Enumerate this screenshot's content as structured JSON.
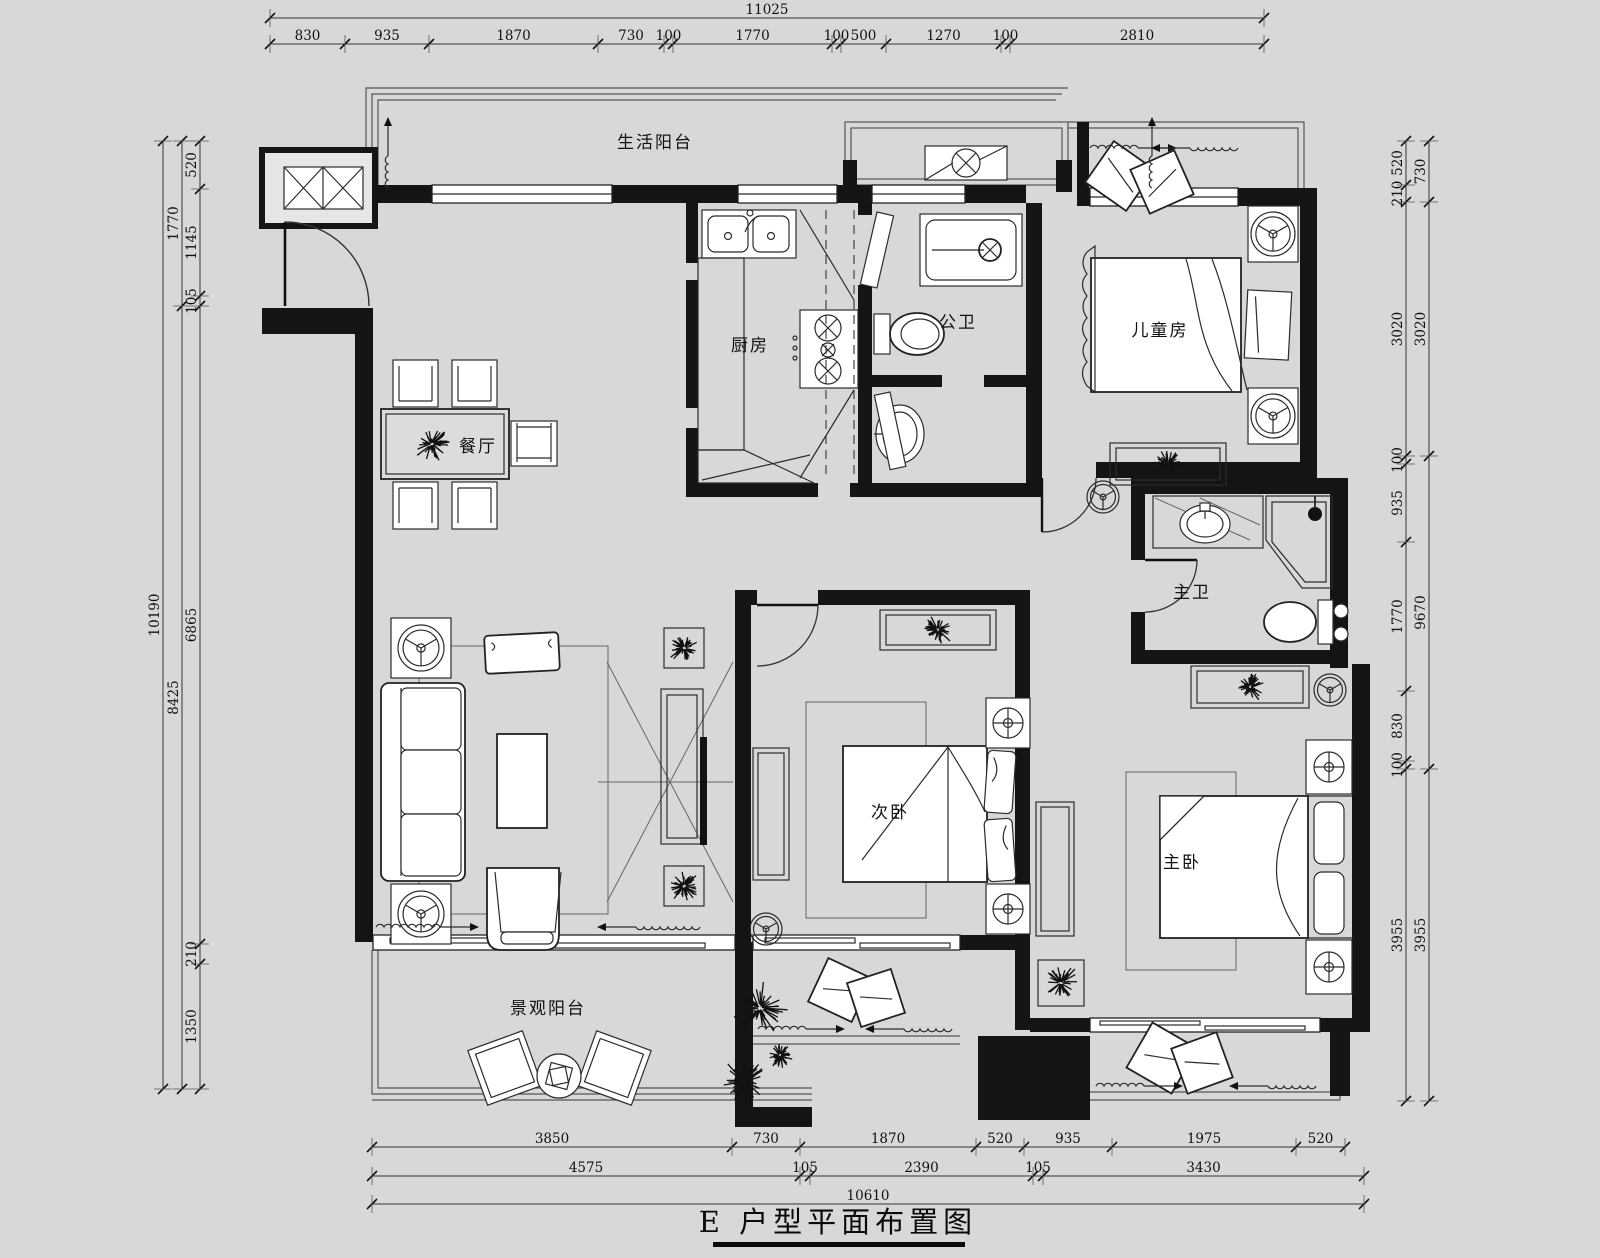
{
  "meta": {
    "background": "#d8d8d8",
    "ink": "#141414"
  },
  "title": {
    "text": "E 户型平面布置图"
  },
  "rooms": {
    "service_balcony": "生活阳台",
    "kitchen": "厨房",
    "public_bath": "公卫",
    "kids_room": "儿童房",
    "dining": "餐厅",
    "master_bath": "主卫",
    "second_bedroom": "次卧",
    "master_bedroom": "主卧",
    "view_balcony": "景观阳台"
  },
  "dims": {
    "top": {
      "total": "11025",
      "segs": [
        "830",
        "935",
        "1870",
        "730",
        "100",
        "1770",
        "100",
        "500",
        "1270",
        "100",
        "2810"
      ]
    },
    "left": {
      "total": "10190",
      "mid": [
        "1770",
        "8425"
      ],
      "inner": [
        "520",
        "1145",
        "105",
        "6865",
        "210",
        "1350"
      ]
    },
    "right": {
      "inner": [
        "520",
        "210",
        "3020",
        "100",
        "935",
        "1770",
        "830",
        "100",
        "3955"
      ],
      "outer": [
        "730",
        "3020",
        "9670",
        "3955"
      ]
    },
    "bottom": {
      "row1": [
        "3850",
        "730",
        "1870",
        "520",
        "935",
        "1975",
        "520"
      ],
      "row2": [
        "4575",
        "105",
        "2390",
        "105",
        "3430"
      ],
      "row3": [
        "10610"
      ]
    }
  }
}
